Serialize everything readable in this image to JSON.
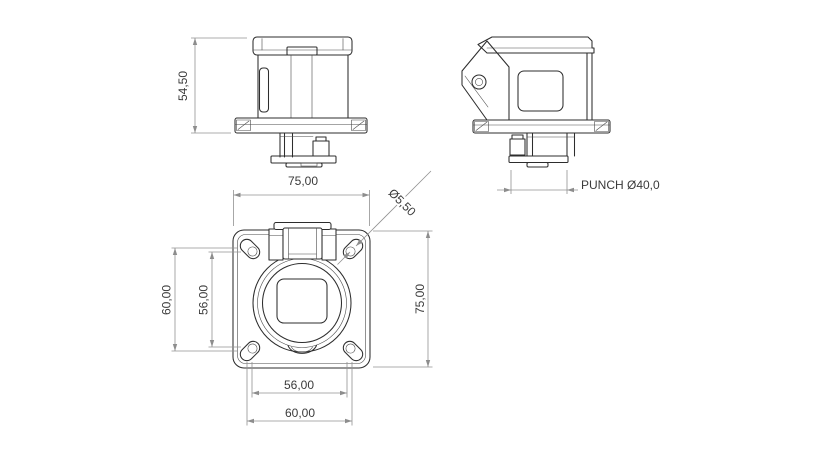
{
  "drawing": {
    "type": "technical-dimension-drawing",
    "views": {
      "front": {
        "dims": {
          "height": "54,50"
        }
      },
      "side": {
        "dims": {
          "punch": "PUNCH Ø40,0"
        }
      },
      "bottom": {
        "dims": {
          "width_top": "75,00",
          "height_right": "75,00",
          "left_outer": "60,00",
          "left_inner": "56,00",
          "bottom_inner": "56,00",
          "bottom_outer": "60,00",
          "hole_diameter": "Ø5,50"
        }
      }
    },
    "colors": {
      "background": "#ffffff",
      "part_edges": "#2d2d2d",
      "dimension_lines": "#929292",
      "dimension_text": "#3a3a3a"
    }
  }
}
